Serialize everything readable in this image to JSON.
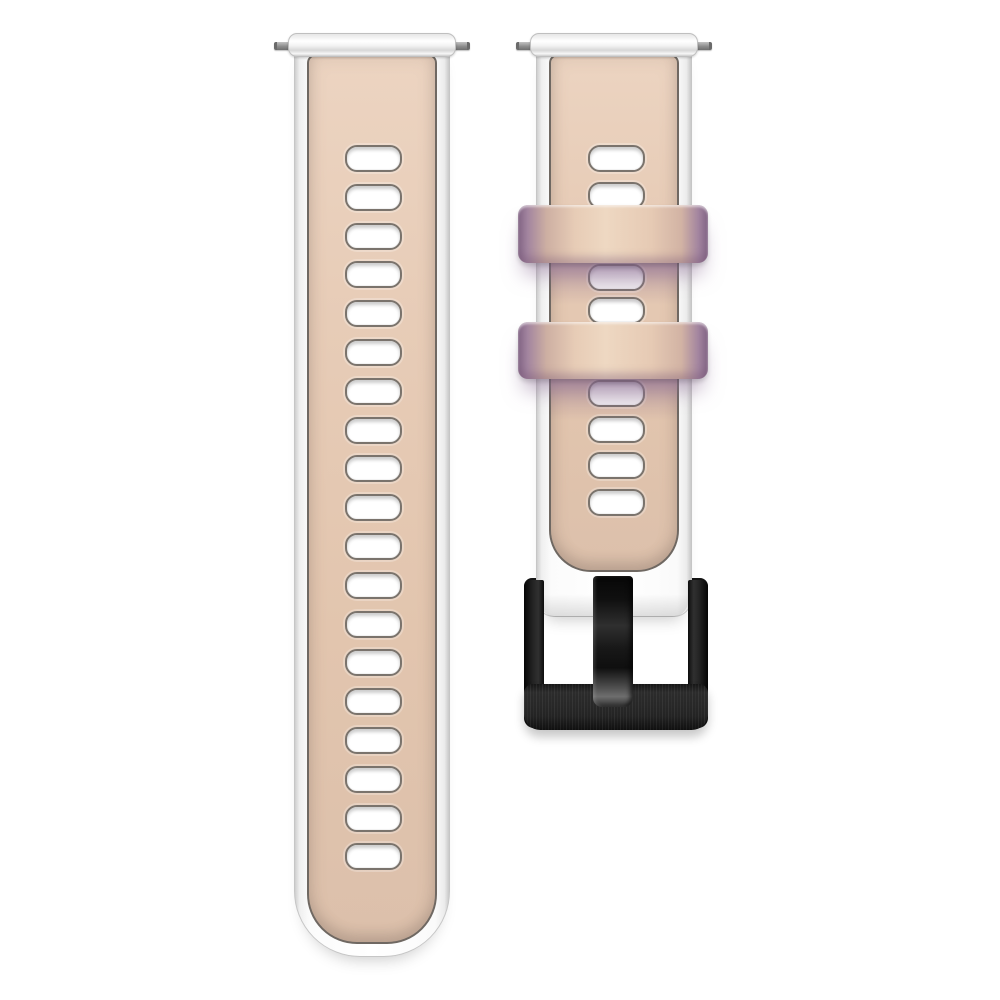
{
  "scene": {
    "background_color": "#ffffff",
    "subject": "Two-piece two-tone silicone watch band: beige center with white edges, two lavender-tinted keeper loops and a black metal pin buckle"
  },
  "colors": {
    "strap_edge_white": "#fbfbfb",
    "strap_center_beige": "#e4c8b2",
    "panel_outline_gray": "#6f6862",
    "keeper_lavender": "#8f7390",
    "buckle_black": "#1b1b1d",
    "prong_highlight_gray": "#6e6e6e",
    "spring_bar_silver": "#8f8f8f"
  },
  "left_strap": {
    "label": "long tail strap piece with adjustment holes",
    "hole_count": 19,
    "hole_top_start": 145,
    "hole_step": 38.8,
    "hole_height": 27
  },
  "right_strap": {
    "label": "buckle-end strap piece",
    "hole_tops": [
      145,
      182,
      264,
      297,
      380,
      416,
      452,
      489
    ],
    "hole_height": 27,
    "keeper_count": 2
  },
  "buckle": {
    "label": "black pin buckle",
    "finish": "brushed black metal with glossy prong"
  }
}
